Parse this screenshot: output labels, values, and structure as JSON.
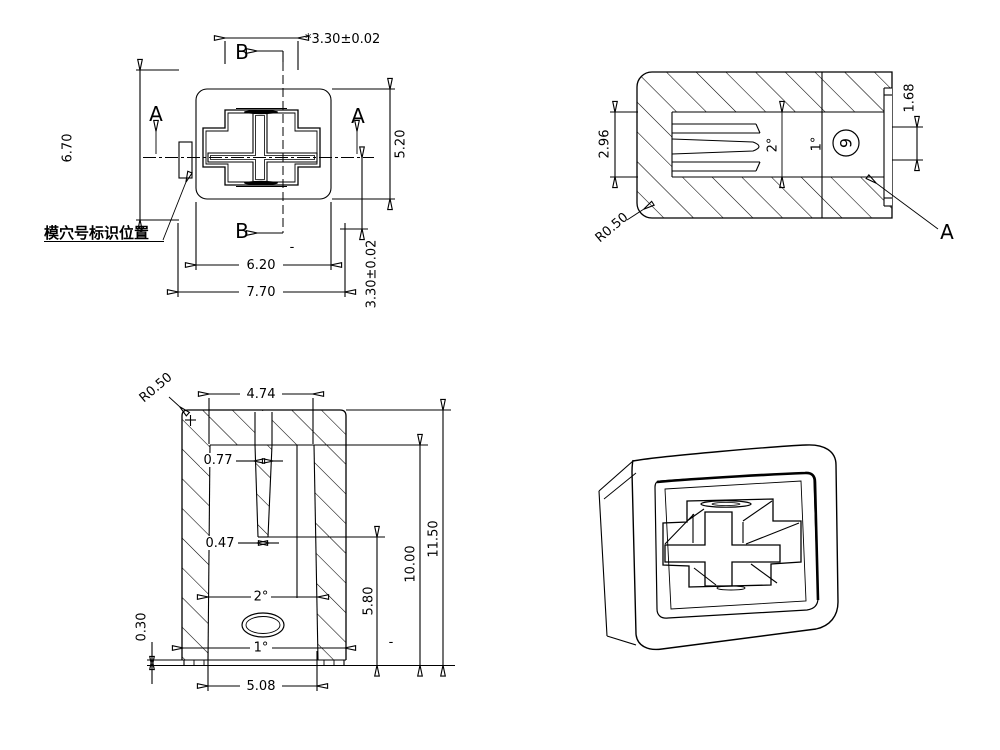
{
  "drawing": {
    "top_view": {
      "section_b": "B",
      "section_a": "A",
      "dim_stem_width": "*3.30±0.02",
      "dim_body_height": "6.70",
      "dim_inner_height": "5.20",
      "dim_stem_height": "3.30±0.02",
      "dim_inner_width": "6.20",
      "dim_body_width": "7.70",
      "cavity_note": "模穴号标识位置",
      "dash_mark": "-"
    },
    "side_section": {
      "dim_channel_height": "2.96",
      "draft_angle_channel": "2°",
      "draft_angle_tip": "1°",
      "cavity_number": "9",
      "dim_end_opening": "1.68",
      "corner_radius": "R0.50",
      "section_label": "A"
    },
    "front_section": {
      "corner_radius": "R0.50",
      "dim_cavity_top_width": "4.74",
      "dim_rib_top": "0.77",
      "dim_rib_bottom": "0.47",
      "draft_angle_inner": "2°",
      "draft_angle_outer": "1°",
      "dim_skirt_thickness": "0.30",
      "dim_mouth_width": "5.08",
      "dim_rib_depth": "5.80",
      "dim_cavity_depth": "10.00",
      "dim_total_height": "11.50",
      "dash_mark": "-"
    }
  }
}
